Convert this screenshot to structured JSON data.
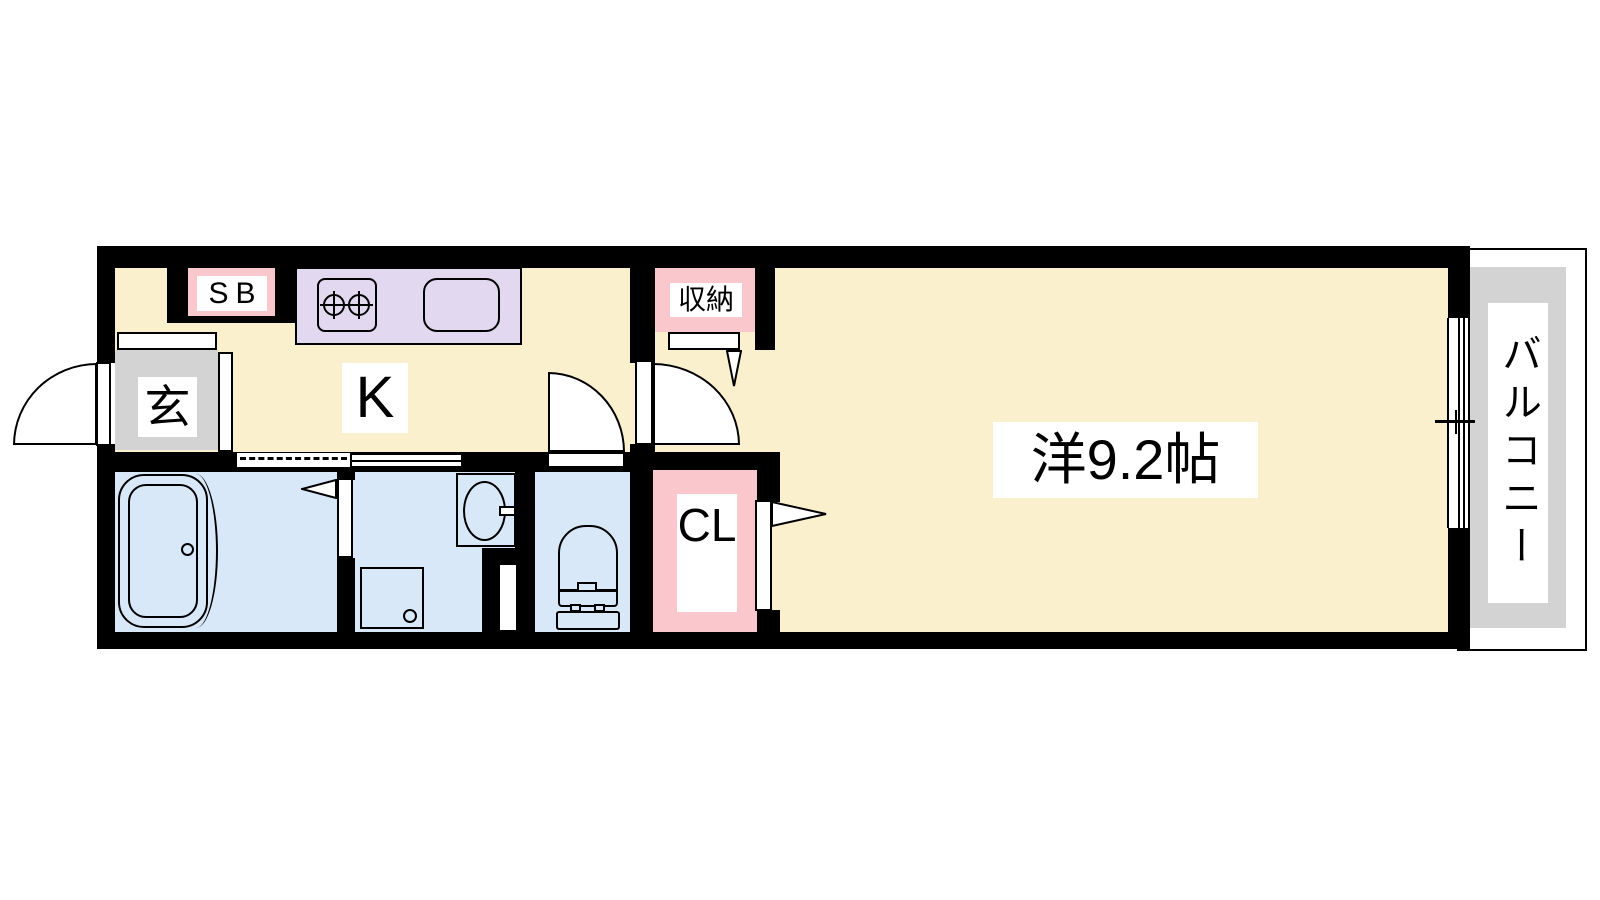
{
  "labels": {
    "shoe_box": "SB",
    "entrance": "玄",
    "kitchen": "K",
    "storage": "収納",
    "closet": "CL",
    "main_room": "洋9.2帖",
    "balcony": "バルコニー"
  },
  "colors": {
    "wall": "#000000",
    "floor_main": "#FBF0CE",
    "floor_wet": "#D9E8F8",
    "counter": "#E2D8F0",
    "pink": "#FAC8CC",
    "gray": "#D3D3D3",
    "label_bg": "#FFFFFF"
  }
}
